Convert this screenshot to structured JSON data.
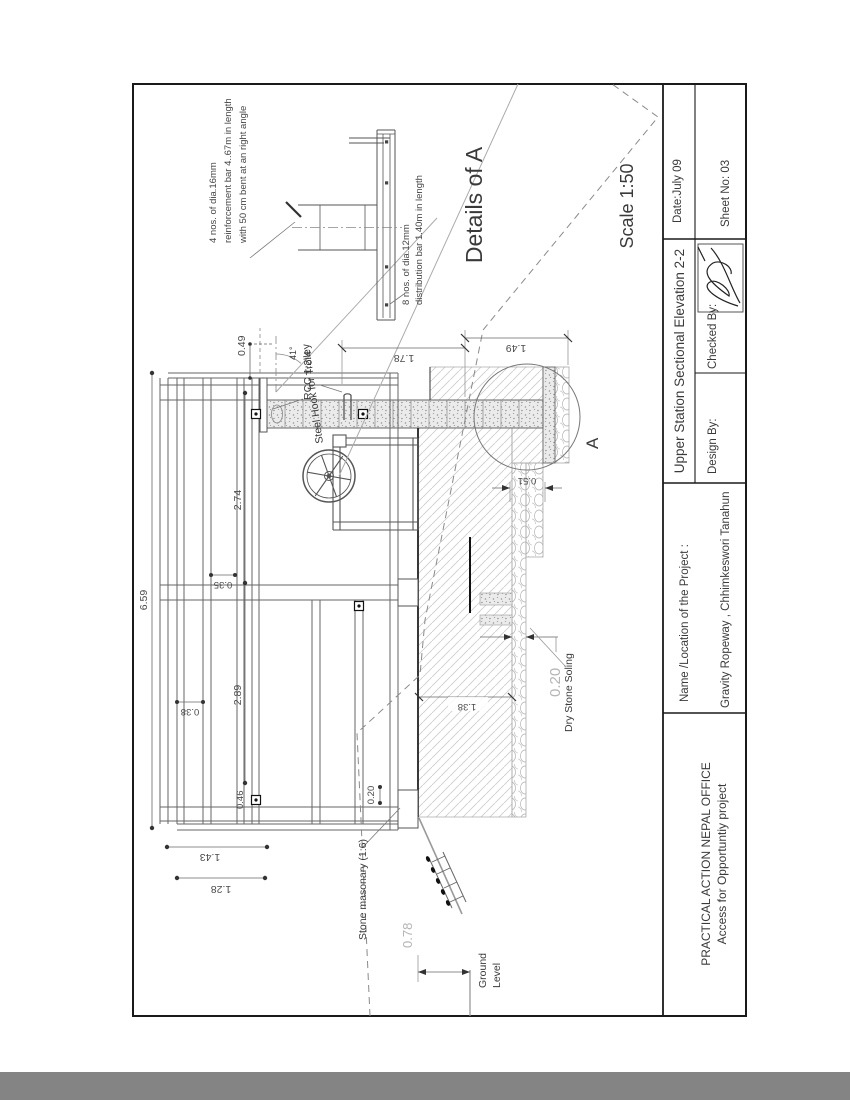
{
  "page": {
    "band_color": "#848484"
  },
  "title_block": {
    "org_line1": "PRACTICAL ACTION NEPAL OFFICE",
    "org_line2": "Access for Opportuntiy project",
    "project_label": "Name /Location of the Project :",
    "project_value": "Gravity Ropeway ,  Chhimkeswori Tanahun",
    "drawing_title": "Upper Station Sectional Elevation 2-2",
    "design_by_label": "Design By:",
    "checked_by_label": "Checked By:",
    "date": "Date:July 09",
    "sheet_no": "Sheet No: 03"
  },
  "detail": {
    "title": "Details of A",
    "scale": "Scale 1:50",
    "marker": "A",
    "note_rebar_l1": "4 nos. of dia.16mm",
    "note_rebar_l2": "reinforcement bar 4..67m in length",
    "note_rebar_l3": "with 50 cm bent at an right angle",
    "note_dist_l1": "8 nos. of dia.12mm",
    "note_dist_l2": "distribution bar 1.40m in length"
  },
  "labels": {
    "rcc": "RCC 1:2:4",
    "steel_hook": "Steel Hook for Trolley",
    "stone_masonry": "Stone masonary (1:6)",
    "dry_stone_soling": "Dry Stone Soling",
    "ground_l1": "Ground",
    "ground_l2": "Level",
    "angle": "41°"
  },
  "dims": {
    "overall": "6.59",
    "span_left": "2.89",
    "span_right": "2.74",
    "rail_gap_a": "0.35",
    "rail_gap_b": "0.38",
    "end_width": "0.46",
    "cap": "0.49",
    "footing_a": "1.43",
    "footing_b": "1.28",
    "post": "0.20",
    "soling": "0.20",
    "wall_upper": "1.78",
    "wall_lower": "1.49",
    "floor_depth": "1.38",
    "slab": "0.51",
    "ground_height": "0.78"
  }
}
